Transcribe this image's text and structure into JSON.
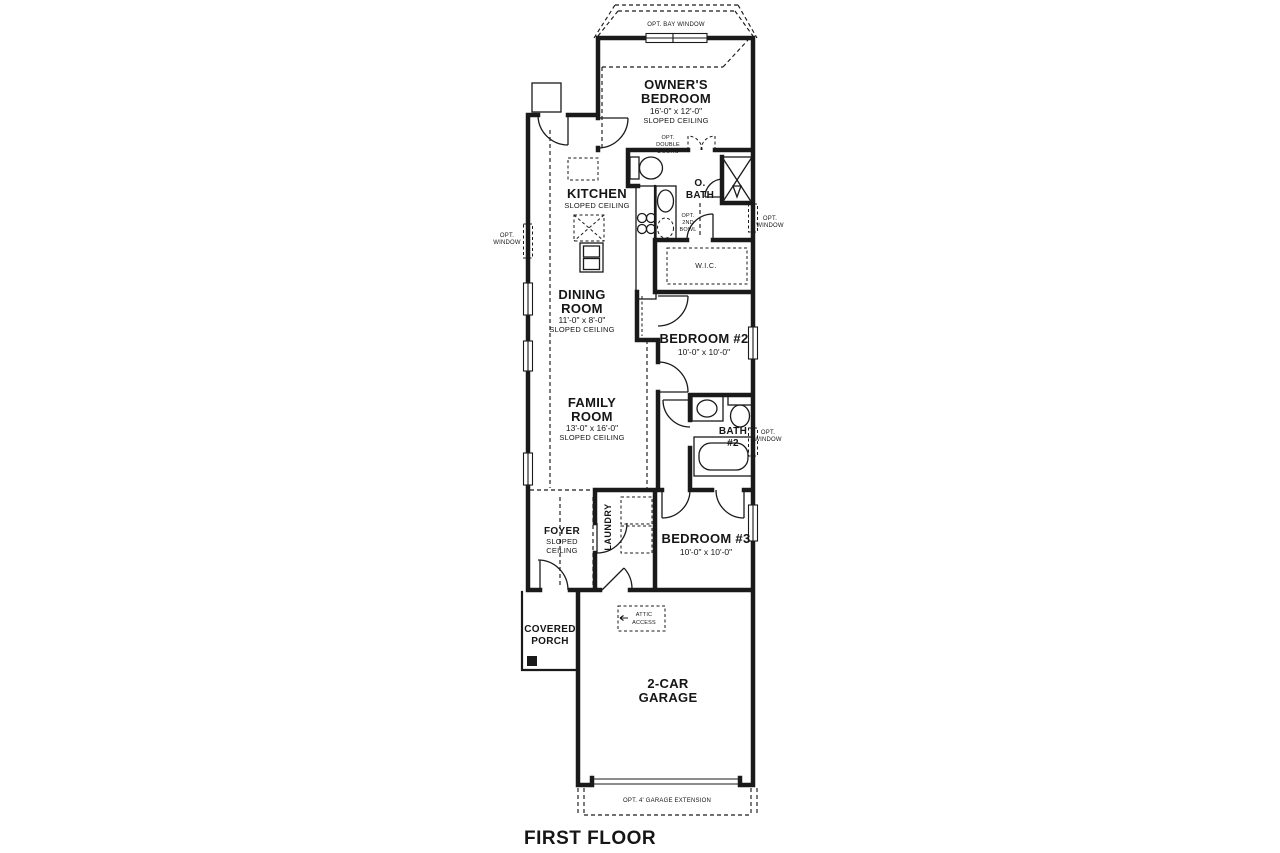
{
  "plan": {
    "title": "FIRST FLOOR",
    "type": "single-family floor plan"
  },
  "colors": {
    "line": "#1a1a1a",
    "background": "#ffffff"
  },
  "rooms": {
    "owners_bedroom": {
      "name": [
        "OWNER'S",
        "BEDROOM"
      ],
      "dims": "16'-0\" x 12'-0\"",
      "ceiling": "SLOPED CEILING"
    },
    "kitchen": {
      "name": [
        "KITCHEN"
      ],
      "ceiling": "SLOPED CEILING"
    },
    "o_bath": {
      "name": [
        "O.",
        "BATH"
      ]
    },
    "wic": {
      "name": [
        "W.I.C."
      ]
    },
    "dining_room": {
      "name": [
        "DINING",
        "ROOM"
      ],
      "dims": "11'-0\" x 8'-0\"",
      "ceiling": "SLOPED CEILING"
    },
    "bedroom_2": {
      "name": [
        "BEDROOM #2"
      ],
      "dims": "10'-0\" x 10'-0\""
    },
    "family_room": {
      "name": [
        "FAMILY",
        "ROOM"
      ],
      "dims": "13'-0\" x 16'-0\"",
      "ceiling": "SLOPED CEILING"
    },
    "bath_2": {
      "name": [
        "BATH",
        "#2"
      ]
    },
    "foyer": {
      "name": [
        "FOYER"
      ],
      "ceiling": [
        "SLOPED",
        "CEILING"
      ]
    },
    "laundry": {
      "name": [
        "LAUNDRY"
      ]
    },
    "bedroom_3": {
      "name": [
        "BEDROOM #3"
      ],
      "dims": "10'-0\" x 10'-0\""
    },
    "covered_porch": {
      "name": [
        "COVERED",
        "PORCH"
      ]
    },
    "garage": {
      "name": [
        "2-CAR",
        "GARAGE"
      ]
    }
  },
  "annotations": {
    "bay_window": "OPT. BAY WINDOW",
    "double_doors": [
      "OPT.",
      "DOUBLE",
      "DOORS"
    ],
    "second_bowl": [
      "OPT.",
      "2ND",
      "BOWL"
    ],
    "opt_window": [
      "OPT.",
      "WINDOW"
    ],
    "attic_access": [
      "ATTIC",
      "ACCESS"
    ],
    "garage_extension": "OPT. 4' GARAGE EXTENSION"
  }
}
